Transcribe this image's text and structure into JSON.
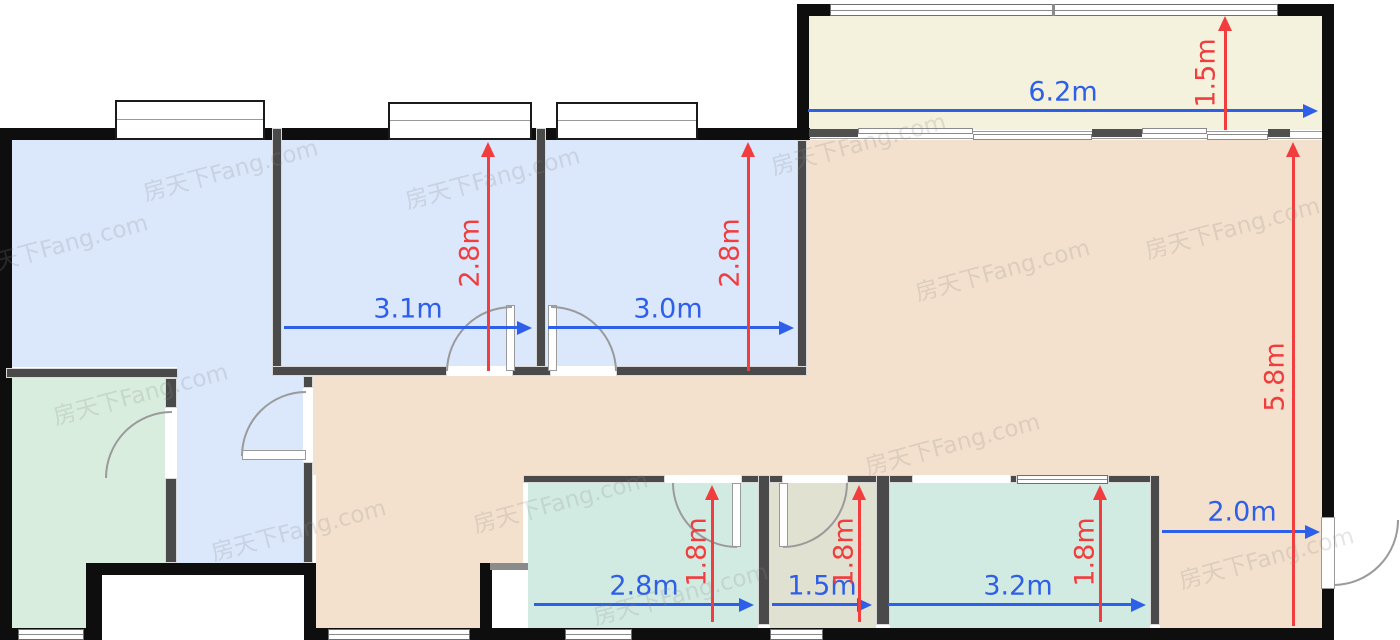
{
  "title": "apartment-floor-plan",
  "watermark_text": "房天下Fang.com",
  "unit": "m",
  "colors": {
    "wall": "#0e0e0e",
    "inner_wall": "#4a4a4a",
    "room_blue": "#dbe7fb",
    "room_peach": "#f4e1cd",
    "room_cream": "#f4f2dc",
    "room_green": "#d9edde",
    "room_teal": "#d2ebe2",
    "room_olive": "#e0e1d1",
    "dim_blue": "#2d5fe8",
    "dim_red": "#f13d3d"
  },
  "rooms": [
    {
      "name": "bedroom-left",
      "fill": "room_blue"
    },
    {
      "name": "bedroom-middle",
      "fill": "room_blue",
      "width_label": "3.1m",
      "depth_label": "2.8m"
    },
    {
      "name": "bedroom-right",
      "fill": "room_blue",
      "width_label": "3.0m",
      "depth_label": "2.8m"
    },
    {
      "name": "balcony",
      "fill": "room_cream",
      "width_label": "6.2m",
      "depth_label": "1.5m"
    },
    {
      "name": "living-dining",
      "fill": "room_peach",
      "depth_label": "5.8m",
      "entry_label": "2.0m"
    },
    {
      "name": "green-room",
      "fill": "room_green"
    },
    {
      "name": "hallway",
      "fill": "room_blue"
    },
    {
      "name": "bathroom-left",
      "fill": "room_teal",
      "width_label": "2.8m",
      "depth_label": "1.8m"
    },
    {
      "name": "utility-room",
      "fill": "room_olive",
      "width_label": "1.5m",
      "depth_label": "1.8m"
    },
    {
      "name": "bathroom-right",
      "fill": "room_teal",
      "width_label": "3.2m",
      "depth_label": "1.8m"
    }
  ],
  "dimensions": {
    "horizontal": [
      {
        "label": "6.2m",
        "x1": 808,
        "x2": 1318,
        "y": 110,
        "lx": 1063,
        "ly": 92
      },
      {
        "label": "3.1m",
        "x1": 284,
        "x2": 532,
        "y": 327,
        "lx": 408,
        "ly": 309
      },
      {
        "label": "3.0m",
        "x1": 548,
        "x2": 794,
        "y": 327,
        "lx": 668,
        "ly": 309
      },
      {
        "label": "2.0m",
        "x1": 1162,
        "x2": 1320,
        "y": 531,
        "lx": 1242,
        "ly": 512
      },
      {
        "label": "2.8m",
        "x1": 534,
        "x2": 754,
        "y": 604,
        "lx": 644,
        "ly": 586
      },
      {
        "label": "1.5m",
        "x1": 772,
        "x2": 872,
        "y": 604,
        "lx": 822,
        "ly": 586
      },
      {
        "label": "3.2m",
        "x1": 888,
        "x2": 1146,
        "y": 604,
        "lx": 1018,
        "ly": 586
      }
    ],
    "vertical": [
      {
        "label": "2.8m",
        "x": 488,
        "y1": 142,
        "y2": 371,
        "lx": 470,
        "ly": 253
      },
      {
        "label": "2.8m",
        "x": 748,
        "y1": 142,
        "y2": 371,
        "lx": 730,
        "ly": 253
      },
      {
        "label": "1.5m",
        "x": 1225,
        "y1": 16,
        "y2": 130,
        "lx": 1206,
        "ly": 73
      },
      {
        "label": "5.8m",
        "x": 1293,
        "y1": 142,
        "y2": 626,
        "lx": 1275,
        "ly": 377
      },
      {
        "label": "1.8m",
        "x": 712,
        "y1": 485,
        "y2": 622,
        "lx": 697,
        "ly": 552
      },
      {
        "label": "1.8m",
        "x": 859,
        "y1": 485,
        "y2": 622,
        "lx": 844,
        "ly": 552
      },
      {
        "label": "1.8m",
        "x": 1100,
        "y1": 485,
        "y2": 622,
        "lx": 1085,
        "ly": 552
      }
    ]
  },
  "watermarks": [
    {
      "x": 60,
      "y": 243
    },
    {
      "x": 230,
      "y": 168
    },
    {
      "x": 140,
      "y": 392
    },
    {
      "x": 298,
      "y": 528
    },
    {
      "x": 492,
      "y": 176
    },
    {
      "x": 560,
      "y": 500
    },
    {
      "x": 680,
      "y": 592
    },
    {
      "x": 858,
      "y": 142
    },
    {
      "x": 1002,
      "y": 268
    },
    {
      "x": 952,
      "y": 442
    },
    {
      "x": 1232,
      "y": 226
    },
    {
      "x": 1266,
      "y": 556
    }
  ]
}
